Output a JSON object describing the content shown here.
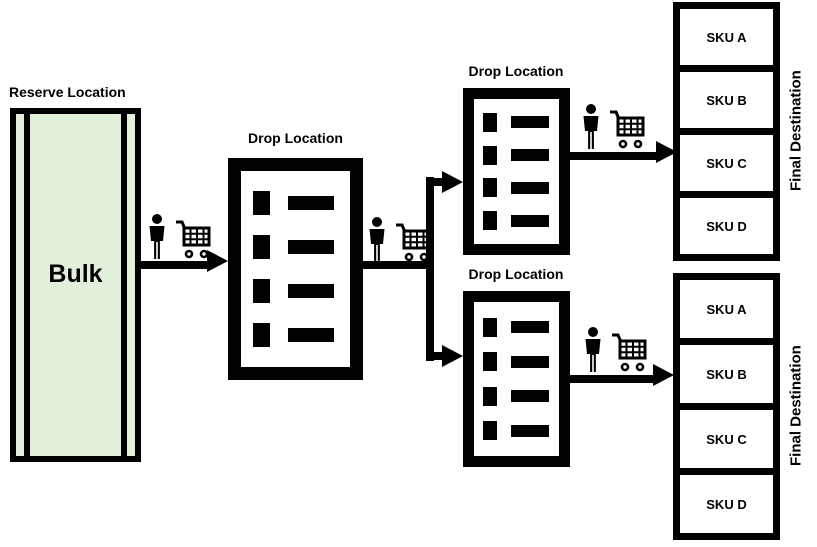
{
  "diagram": {
    "reserve_location": {
      "label": "Reserve Location",
      "bulk_label": "Bulk",
      "fill_color": "#e2efda",
      "slots": 1
    },
    "drop_location_middle": {
      "label": "Drop Location",
      "slots": 4
    },
    "drop_location_upper": {
      "label": "Drop Location",
      "slots": 4
    },
    "drop_location_lower": {
      "label": "Drop Location",
      "slots": 4
    },
    "final_destination_upper": {
      "label": "Final Destination",
      "skus": [
        "SKU A",
        "SKU B",
        "SKU C",
        "SKU D"
      ]
    },
    "final_destination_lower": {
      "label": "Final Destination",
      "skus": [
        "SKU A",
        "SKU B",
        "SKU C",
        "SKU D"
      ]
    },
    "transport_icons": [
      "person-icon",
      "shopping-cart-icon"
    ],
    "colors": {
      "line": "#000000",
      "bulk_fill": "#e2efda",
      "background": "#ffffff"
    }
  }
}
